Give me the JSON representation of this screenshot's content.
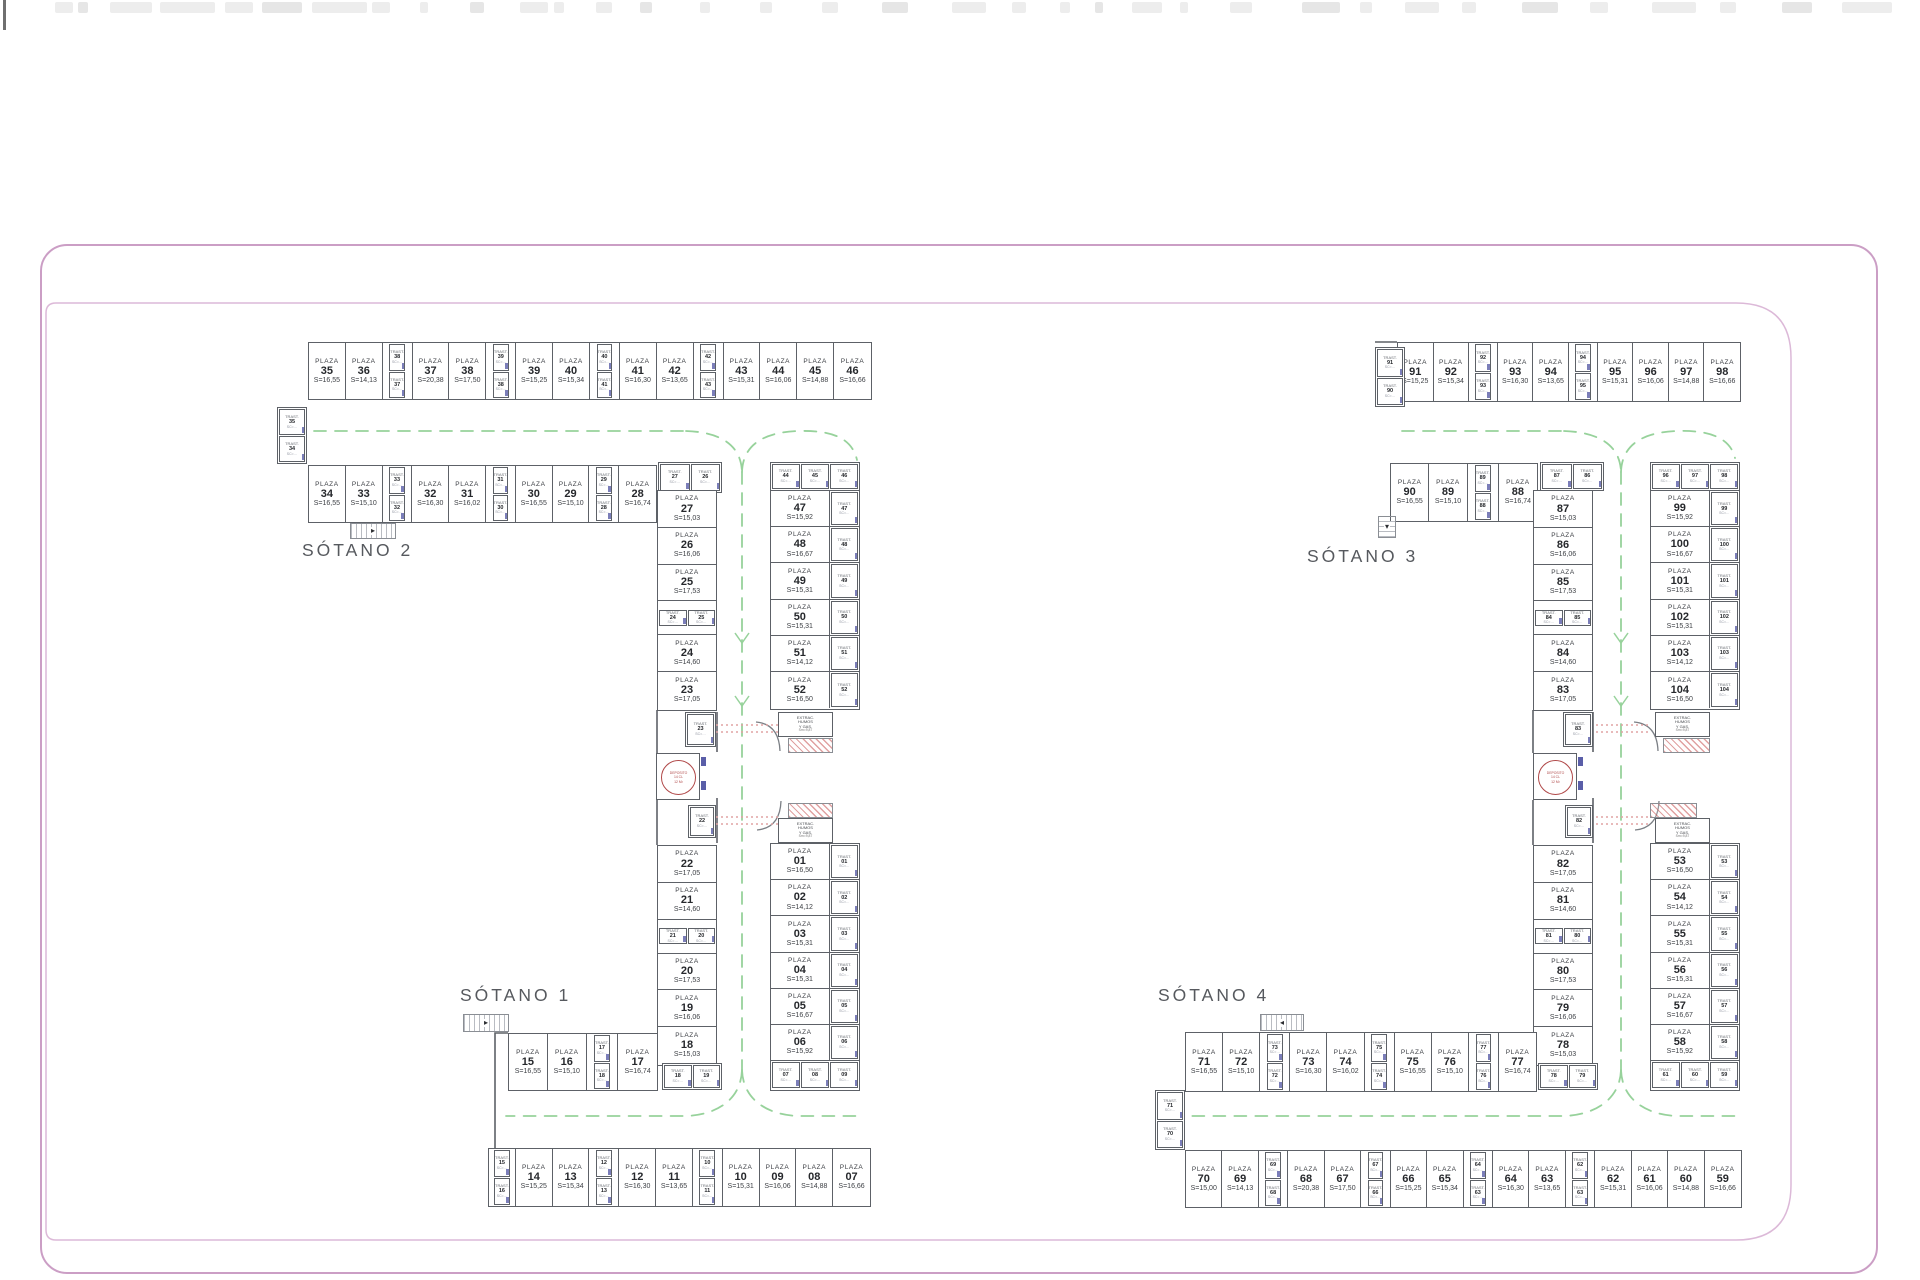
{
  "colors": {
    "wall": "#5d6167",
    "text": "#3c3f44",
    "number": "#26282c",
    "trast_text": "#666a70",
    "lane_green": "#97d29b",
    "door_blue": "#5a5ea8",
    "hatch_red": "#cf6e6e",
    "circle_red": "#b04848",
    "border_pink_outer": "#cb9ec5",
    "border_pink_inner": "#dcb9d8",
    "label_gray": "#56595e"
  },
  "labels": {
    "sotano_1": "SÓTANO 1",
    "sotano_2": "SÓTANO 2",
    "sotano_3": "SÓTANO 3",
    "sotano_4": "SÓTANO 4"
  },
  "terms": {
    "plaza": "PLAZA",
    "trast": "TRAST.",
    "area_prefix": "S=",
    "trast_sub": "SC=…"
  },
  "rooms": {
    "deposit": [
      "DEPOSITO",
      "14 CL",
      "12 M²"
    ],
    "extraction": [
      "EXTRAC.",
      "HUMOS",
      "Y GAS.",
      "Sm=9,87"
    ]
  },
  "plazas": {
    "s2_top_row": [
      {
        "k": "p",
        "n": "35",
        "s": "16,55"
      },
      {
        "k": "p",
        "n": "36",
        "s": "14,13"
      },
      {
        "k": "tp",
        "a": "38",
        "b": "37"
      },
      {
        "k": "p",
        "n": "37",
        "s": "20,38"
      },
      {
        "k": "p",
        "n": "38",
        "s": "17,50"
      },
      {
        "k": "tp",
        "a": "39",
        "b": "38"
      },
      {
        "k": "p",
        "n": "39",
        "s": "15,25"
      },
      {
        "k": "p",
        "n": "40",
        "s": "15,34"
      },
      {
        "k": "tp",
        "a": "40",
        "b": "41"
      },
      {
        "k": "p",
        "n": "41",
        "s": "16,30"
      },
      {
        "k": "p",
        "n": "42",
        "s": "13,65"
      },
      {
        "k": "tp",
        "a": "42",
        "b": "43"
      },
      {
        "k": "p",
        "n": "43",
        "s": "15,31"
      },
      {
        "k": "p",
        "n": "44",
        "s": "16,06"
      },
      {
        "k": "p",
        "n": "45",
        "s": "14,88"
      },
      {
        "k": "p",
        "n": "46",
        "s": "16,66"
      }
    ],
    "s2_second_row": [
      {
        "k": "p",
        "n": "34",
        "s": "16,55"
      },
      {
        "k": "p",
        "n": "33",
        "s": "15,10"
      },
      {
        "k": "tp",
        "a": "33",
        "b": "32"
      },
      {
        "k": "p",
        "n": "32",
        "s": "16,30"
      },
      {
        "k": "p",
        "n": "31",
        "s": "16,02"
      },
      {
        "k": "tp",
        "a": "31",
        "b": "30"
      },
      {
        "k": "p",
        "n": "30",
        "s": "16,55"
      },
      {
        "k": "p",
        "n": "29",
        "s": "15,10"
      },
      {
        "k": "tp",
        "a": "29",
        "b": "28"
      },
      {
        "k": "p",
        "n": "28",
        "s": "16,74"
      }
    ],
    "s2_edge_trasts": [
      "35",
      "34"
    ],
    "s2_corner_trasts": [
      "27",
      "26"
    ],
    "s2_spine_west": [
      {
        "k": "p",
        "n": "27",
        "s": "15,03"
      },
      {
        "k": "p",
        "n": "26",
        "s": "16,06"
      },
      {
        "k": "p",
        "n": "25",
        "s": "17,53"
      },
      {
        "k": "tph",
        "a": "24",
        "b": "25"
      },
      {
        "k": "p",
        "n": "24",
        "s": "14,60"
      },
      {
        "k": "p",
        "n": "23",
        "s": "17,05"
      }
    ],
    "s2_spine_east": {
      "top_trasts": [
        "44",
        "45",
        "46"
      ],
      "rows": [
        {
          "n": "47",
          "s": "15,92",
          "t": "47"
        },
        {
          "n": "48",
          "s": "16,67",
          "t": "48"
        },
        {
          "n": "49",
          "s": "15,31",
          "t": "49"
        },
        {
          "n": "50",
          "s": "15,31",
          "t": "50"
        },
        {
          "n": "51",
          "s": "14,12",
          "t": "51"
        },
        {
          "n": "52",
          "s": "16,50",
          "t": "52"
        }
      ]
    },
    "singles": {
      "t23": "23",
      "t22": "22",
      "t83": "83",
      "t82": "82"
    },
    "s1_spine_west": [
      {
        "k": "p",
        "n": "22",
        "s": "17,05"
      },
      {
        "k": "p",
        "n": "21",
        "s": "14,60"
      },
      {
        "k": "tph",
        "a": "21",
        "b": "20"
      },
      {
        "k": "p",
        "n": "20",
        "s": "17,53"
      },
      {
        "k": "p",
        "n": "19",
        "s": "16,06"
      },
      {
        "k": "p",
        "n": "18",
        "s": "15,03"
      }
    ],
    "s1_below_trasts": [
      "18",
      "19"
    ],
    "s1_spine_east": {
      "rows": [
        {
          "n": "01",
          "s": "16,50",
          "t": "01"
        },
        {
          "n": "02",
          "s": "14,12",
          "t": "02"
        },
        {
          "n": "03",
          "s": "15,31",
          "t": "03"
        },
        {
          "n": "04",
          "s": "15,31",
          "t": "04"
        },
        {
          "n": "05",
          "s": "16,67",
          "t": "05"
        },
        {
          "n": "06",
          "s": "15,92",
          "t": "06"
        }
      ],
      "bottom_trasts": [
        "07",
        "08",
        "09"
      ]
    },
    "s1_upper_row": [
      {
        "k": "p",
        "n": "15",
        "s": "16,55"
      },
      {
        "k": "p",
        "n": "16",
        "s": "15,10"
      },
      {
        "k": "tp",
        "a": "17",
        "b": "18"
      },
      {
        "k": "p",
        "n": "17",
        "s": "16,74"
      }
    ],
    "s1_bottom_row": [
      {
        "k": "tv",
        "a": "15",
        "b": "16"
      },
      {
        "k": "p",
        "n": "14",
        "s": "15,25"
      },
      {
        "k": "p",
        "n": "13",
        "s": "15,34"
      },
      {
        "k": "tp",
        "a": "12",
        "b": "13"
      },
      {
        "k": "p",
        "n": "12",
        "s": "16,30"
      },
      {
        "k": "p",
        "n": "11",
        "s": "13,65"
      },
      {
        "k": "tp",
        "a": "10",
        "b": "11"
      },
      {
        "k": "p",
        "n": "10",
        "s": "15,31"
      },
      {
        "k": "p",
        "n": "09",
        "s": "16,06"
      },
      {
        "k": "p",
        "n": "08",
        "s": "14,88"
      },
      {
        "k": "p",
        "n": "07",
        "s": "16,66"
      }
    ],
    "s3_top_row": [
      {
        "k": "p",
        "n": "91",
        "s": "15,25"
      },
      {
        "k": "p",
        "n": "92",
        "s": "15,34"
      },
      {
        "k": "tp",
        "a": "92",
        "b": "93"
      },
      {
        "k": "p",
        "n": "93",
        "s": "16,30"
      },
      {
        "k": "p",
        "n": "94",
        "s": "13,65"
      },
      {
        "k": "tp",
        "a": "94",
        "b": "95"
      },
      {
        "k": "p",
        "n": "95",
        "s": "15,31"
      },
      {
        "k": "p",
        "n": "96",
        "s": "16,06"
      },
      {
        "k": "p",
        "n": "97",
        "s": "14,88"
      },
      {
        "k": "p",
        "n": "98",
        "s": "16,66"
      }
    ],
    "s3_edge_trasts": [
      "91",
      "90"
    ],
    "s3_second_row": [
      {
        "k": "p",
        "n": "90",
        "s": "16,55"
      },
      {
        "k": "p",
        "n": "89",
        "s": "15,10"
      },
      {
        "k": "tp",
        "a": "89",
        "b": "88"
      },
      {
        "k": "p",
        "n": "88",
        "s": "16,74"
      }
    ],
    "s3_corner_trasts": [
      "87",
      "86"
    ],
    "s3_spine_west": [
      {
        "k": "p",
        "n": "87",
        "s": "15,03"
      },
      {
        "k": "p",
        "n": "86",
        "s": "16,06"
      },
      {
        "k": "p",
        "n": "85",
        "s": "17,53"
      },
      {
        "k": "tph",
        "a": "84",
        "b": "85"
      },
      {
        "k": "p",
        "n": "84",
        "s": "14,60"
      },
      {
        "k": "p",
        "n": "83",
        "s": "17,05"
      }
    ],
    "s3_spine_east": {
      "top_trasts": [
        "96",
        "97",
        "98"
      ],
      "rows": [
        {
          "n": "99",
          "s": "15,92",
          "t": "99"
        },
        {
          "n": "100",
          "s": "16,67",
          "t": "100"
        },
        {
          "n": "101",
          "s": "15,31",
          "t": "101"
        },
        {
          "n": "102",
          "s": "15,31",
          "t": "102"
        },
        {
          "n": "103",
          "s": "14,12",
          "t": "103"
        },
        {
          "n": "104",
          "s": "16,50",
          "t": "104"
        }
      ]
    },
    "s4_spine_west": [
      {
        "k": "p",
        "n": "82",
        "s": "17,05"
      },
      {
        "k": "p",
        "n": "81",
        "s": "14,60"
      },
      {
        "k": "tph",
        "a": "81",
        "b": "80"
      },
      {
        "k": "p",
        "n": "80",
        "s": "17,53"
      },
      {
        "k": "p",
        "n": "79",
        "s": "16,06"
      },
      {
        "k": "p",
        "n": "78",
        "s": "15,03"
      }
    ],
    "s4_below_trasts": [
      "78",
      "79"
    ],
    "s4_spine_east": {
      "rows": [
        {
          "n": "53",
          "s": "16,50",
          "t": "53"
        },
        {
          "n": "54",
          "s": "14,12",
          "t": "54"
        },
        {
          "n": "55",
          "s": "15,31",
          "t": "55"
        },
        {
          "n": "56",
          "s": "15,31",
          "t": "56"
        },
        {
          "n": "57",
          "s": "16,67",
          "t": "57"
        },
        {
          "n": "58",
          "s": "15,92",
          "t": "58"
        }
      ],
      "bottom_trasts": [
        "61",
        "60",
        "59"
      ]
    },
    "s4_upper_row": [
      {
        "k": "p",
        "n": "71",
        "s": "16,55"
      },
      {
        "k": "p",
        "n": "72",
        "s": "15,10"
      },
      {
        "k": "tp",
        "a": "73",
        "b": "72"
      },
      {
        "k": "p",
        "n": "73",
        "s": "16,30"
      },
      {
        "k": "p",
        "n": "74",
        "s": "16,02"
      },
      {
        "k": "tp",
        "a": "75",
        "b": "74"
      },
      {
        "k": "p",
        "n": "75",
        "s": "16,55"
      },
      {
        "k": "p",
        "n": "76",
        "s": "15,10"
      },
      {
        "k": "tp",
        "a": "77",
        "b": "76"
      },
      {
        "k": "p",
        "n": "77",
        "s": "16,74"
      }
    ],
    "s4_edge_trasts": [
      "71",
      "70"
    ],
    "s4_bottom_row": [
      {
        "k": "p",
        "n": "70",
        "s": "15,00"
      },
      {
        "k": "p",
        "n": "69",
        "s": "14,13"
      },
      {
        "k": "tp",
        "a": "69",
        "b": "68"
      },
      {
        "k": "p",
        "n": "68",
        "s": "20,38"
      },
      {
        "k": "p",
        "n": "67",
        "s": "17,50"
      },
      {
        "k": "tp",
        "a": "67",
        "b": "66"
      },
      {
        "k": "p",
        "n": "66",
        "s": "15,25"
      },
      {
        "k": "p",
        "n": "65",
        "s": "15,34"
      },
      {
        "k": "tp",
        "a": "64",
        "b": "63"
      },
      {
        "k": "p",
        "n": "64",
        "s": "16,30"
      },
      {
        "k": "p",
        "n": "63",
        "s": "13,65"
      },
      {
        "k": "tp",
        "a": "62",
        "b": "63"
      },
      {
        "k": "p",
        "n": "62",
        "s": "15,31"
      },
      {
        "k": "p",
        "n": "61",
        "s": "16,06"
      },
      {
        "k": "p",
        "n": "60",
        "s": "14,88"
      },
      {
        "k": "p",
        "n": "59",
        "s": "16,66"
      }
    ]
  }
}
